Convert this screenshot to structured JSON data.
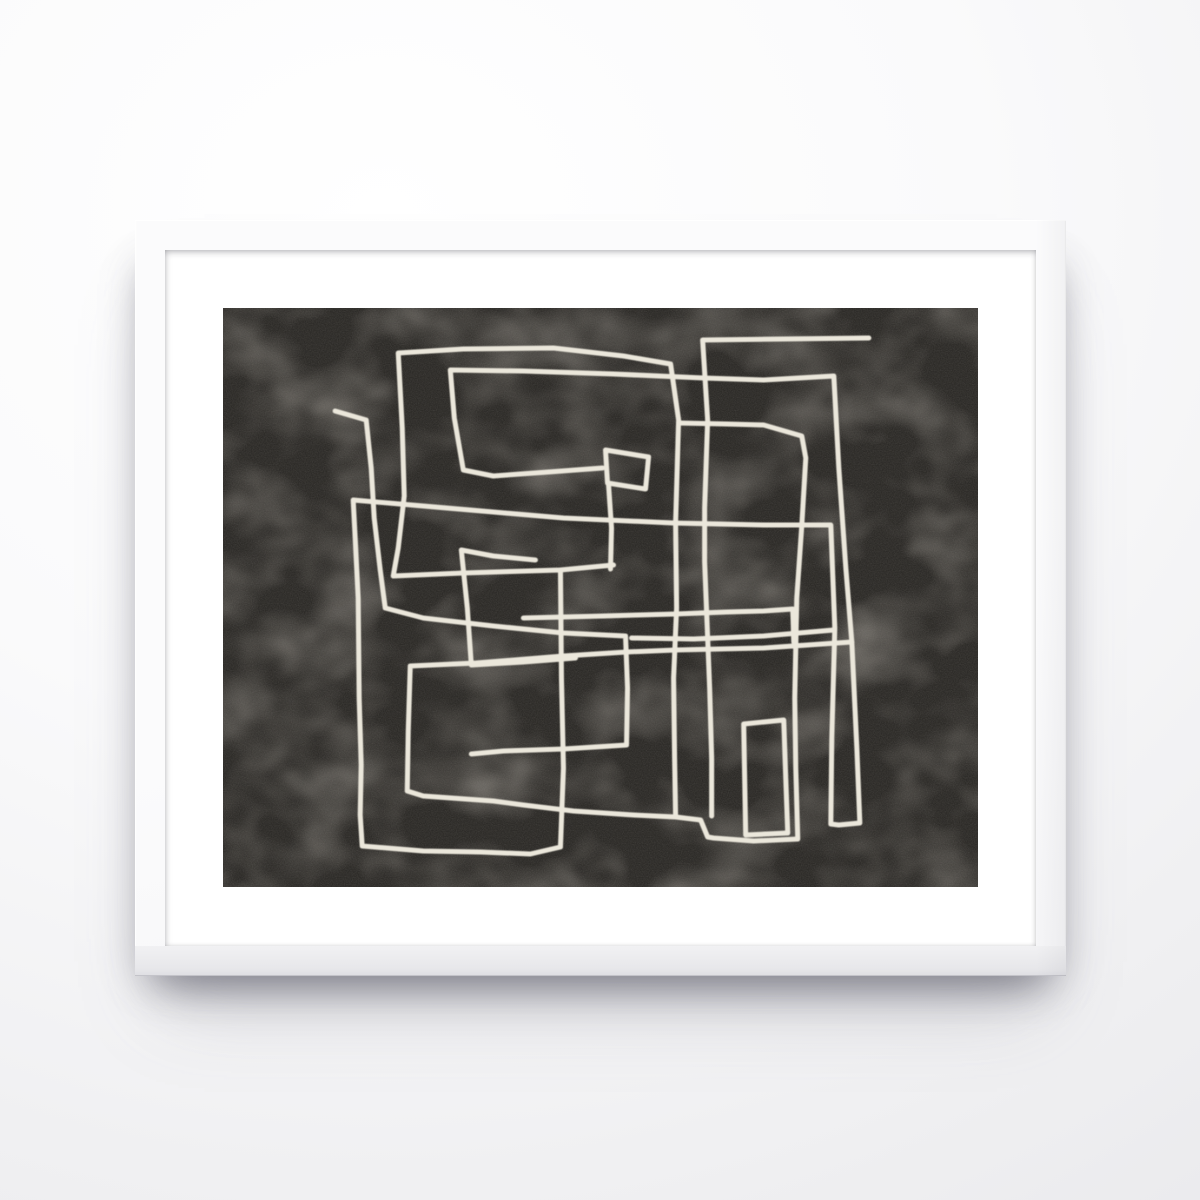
{
  "scene": {
    "description": "Photograph of a framed abstract poster hanging on a light wall: thin white frame, wide white mat, black textured print with a continuous cream one-line maze drawing",
    "text_content": "none"
  },
  "theme": {
    "wall_base": "#f2f2f4",
    "wall_highlight": "#ffffff",
    "wall_shade": "#e9e9ec",
    "frame_color": "#fbfbfc",
    "frame_bottom_edge": "#c3c3c9",
    "mat_color": "#ffffff",
    "art_background": "#2d2b28",
    "art_texture_blotch": "#544f47",
    "art_line_color": "#ebe7db"
  },
  "frame": {
    "x": 135,
    "y": 220,
    "width": 931,
    "height": 756,
    "bar_thickness": 30,
    "mat_width": 58
  },
  "artwork": {
    "width": 754,
    "height": 579,
    "line_width": 5,
    "line_color": "#ebe7db",
    "lines": [
      {
        "name": "spiral-rect",
        "points": [
          [
            382,
            142
          ],
          [
            425,
            149
          ],
          [
            422,
            181
          ],
          [
            384,
            175
          ],
          [
            382,
            142
          ]
        ]
      },
      {
        "name": "spiral-stem",
        "points": [
          [
            385,
            176
          ],
          [
            388,
            220
          ],
          [
            387,
            261
          ]
        ]
      },
      {
        "name": "main-loop",
        "points": [
          [
            390,
            257
          ],
          [
            337,
            262
          ],
          [
            240,
            265
          ],
          [
            170,
            268
          ],
          [
            175,
            240
          ],
          [
            181,
            188
          ],
          [
            179,
            120
          ],
          [
            175,
            45
          ],
          [
            240,
            41
          ],
          [
            330,
            40
          ],
          [
            400,
            48
          ],
          [
            447,
            56
          ],
          [
            455,
            112
          ],
          [
            452,
            215
          ],
          [
            453,
            300
          ],
          [
            450,
            370
          ],
          [
            451,
            450
          ],
          [
            452,
            509
          ]
        ]
      },
      {
        "name": "right-spiral",
        "points": [
          [
            379,
            160
          ],
          [
            325,
            164
          ],
          [
            270,
            168
          ],
          [
            240,
            162
          ],
          [
            231,
            110
          ],
          [
            227,
            62
          ],
          [
            300,
            63
          ],
          [
            390,
            66
          ],
          [
            480,
            70
          ],
          [
            540,
            72
          ],
          [
            610,
            68
          ],
          [
            615,
            160
          ],
          [
            622,
            260
          ],
          [
            628,
            334
          ],
          [
            633,
            440
          ],
          [
            636,
            515
          ],
          [
            615,
            517
          ],
          [
            607,
            516
          ],
          [
            608,
            430
          ],
          [
            611,
            320
          ],
          [
            607,
            217
          ],
          [
            540,
            217
          ],
          [
            450,
            215
          ],
          [
            340,
            210
          ],
          [
            270,
            204
          ],
          [
            200,
            198
          ],
          [
            130,
            192
          ],
          [
            132,
            230
          ],
          [
            135,
            290
          ],
          [
            136,
            390
          ],
          [
            138,
            457
          ],
          [
            137,
            507
          ],
          [
            139,
            538
          ],
          [
            200,
            543
          ],
          [
            257,
            544
          ],
          [
            307,
            546
          ],
          [
            337,
            539
          ],
          [
            340,
            460
          ],
          [
            338,
            370
          ],
          [
            337,
            262
          ]
        ]
      },
      {
        "name": "outer-loop",
        "points": [
          [
            455,
            115
          ],
          [
            503,
            116
          ],
          [
            540,
            117
          ],
          [
            578,
            128
          ],
          [
            582,
            150
          ],
          [
            578,
            218
          ],
          [
            573,
            290
          ],
          [
            571,
            390
          ],
          [
            572,
            460
          ],
          [
            574,
            531
          ],
          [
            530,
            533
          ],
          [
            490,
            530
          ],
          [
            484,
            529
          ],
          [
            477,
            512
          ],
          [
            452,
            509
          ],
          [
            410,
            507
          ],
          [
            350,
            503
          ],
          [
            300,
            497
          ],
          [
            270,
            493
          ],
          [
            200,
            488
          ],
          [
            184,
            483
          ],
          [
            185,
            423
          ],
          [
            187,
            358
          ],
          [
            253,
            355
          ],
          [
            340,
            348
          ],
          [
            403,
            344
          ],
          [
            452,
            342
          ],
          [
            540,
            340
          ],
          [
            628,
            334
          ]
        ]
      },
      {
        "name": "tail-hook",
        "points": [
          [
            112,
            103
          ],
          [
            143,
            112
          ],
          [
            148,
            160
          ],
          [
            151,
            210
          ],
          [
            157,
            262
          ],
          [
            162,
            300
          ],
          [
            200,
            310
          ],
          [
            270,
            318
          ],
          [
            340,
            325
          ],
          [
            402,
            328
          ],
          [
            404,
            380
          ],
          [
            403,
            437
          ],
          [
            340,
            441
          ],
          [
            280,
            443
          ],
          [
            248,
            446
          ]
        ]
      },
      {
        "name": "top-line",
        "points": [
          [
            645,
            30
          ],
          [
            560,
            31
          ],
          [
            479,
            32
          ],
          [
            484,
            112
          ],
          [
            481,
            200
          ],
          [
            481,
            254
          ],
          [
            486,
            380
          ],
          [
            488,
            450
          ],
          [
            488,
            508
          ]
        ]
      },
      {
        "name": "upper-cross",
        "points": [
          [
            300,
            310
          ],
          [
            380,
            308
          ],
          [
            452,
            306
          ],
          [
            503,
            304
          ],
          [
            540,
            303
          ],
          [
            569,
            301
          ],
          [
            570,
            334
          ]
        ]
      },
      {
        "name": "mid-branch",
        "points": [
          [
            312,
            252
          ],
          [
            270,
            248
          ],
          [
            238,
            242
          ],
          [
            244,
            300
          ],
          [
            248,
            357
          ],
          [
            300,
            354
          ],
          [
            352,
            350
          ]
        ]
      },
      {
        "name": "band-right",
        "points": [
          [
            408,
            330
          ],
          [
            470,
            331
          ],
          [
            540,
            328
          ],
          [
            610,
            322
          ]
        ]
      },
      {
        "name": "small-rect",
        "points": [
          [
            520,
            416
          ],
          [
            560,
            412
          ],
          [
            562,
            470
          ],
          [
            564,
            525
          ],
          [
            522,
            527
          ],
          [
            520,
            416
          ]
        ]
      }
    ]
  }
}
